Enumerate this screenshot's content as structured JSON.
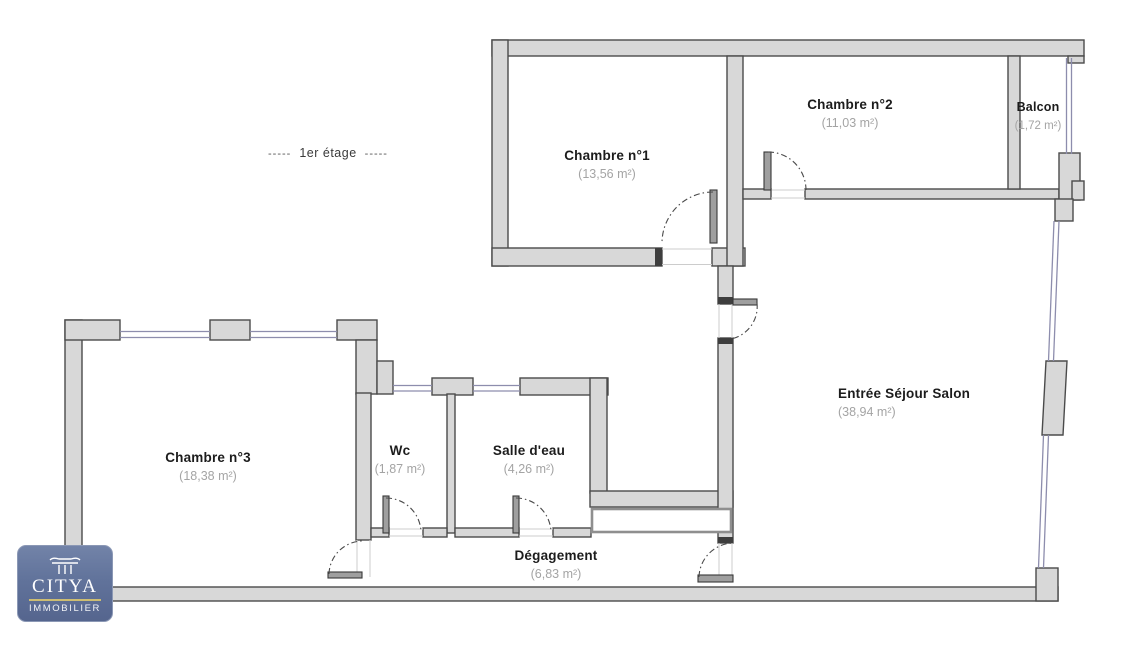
{
  "floor": {
    "dashes_left": "-----",
    "label": "1er étage",
    "dashes_right": "-----"
  },
  "rooms": [
    {
      "name": "Chambre n°1",
      "area": "(13,56 m²)"
    },
    {
      "name": "Chambre n°2",
      "area": "(11,03 m²)"
    },
    {
      "name": "Balcon",
      "area": "(1,72 m²)"
    },
    {
      "name": "Entrée Séjour Salon",
      "area": "(38,94 m²)"
    },
    {
      "name": "Chambre n°3",
      "area": "(18,38 m²)"
    },
    {
      "name": "Wc",
      "area": "(1,87 m²)"
    },
    {
      "name": "Salle d'eau",
      "area": "(4,26 m²)"
    },
    {
      "name": "Dégagement",
      "area": "(6,83 m²)"
    }
  ],
  "logo": {
    "brand": "CITYA",
    "subtitle": "IMMOBILIER"
  },
  "colors": {
    "wall_fill": "#d8d8d8",
    "wall_stroke": "#4b4b4b",
    "window_line": "#8d8dad",
    "door_arc": "#4a4a4a",
    "room_name_text": "#1c1c1c",
    "room_area_text": "#a4a4a4",
    "logo_background": "#61739b",
    "logo_accent_line": "#cdbd72"
  }
}
